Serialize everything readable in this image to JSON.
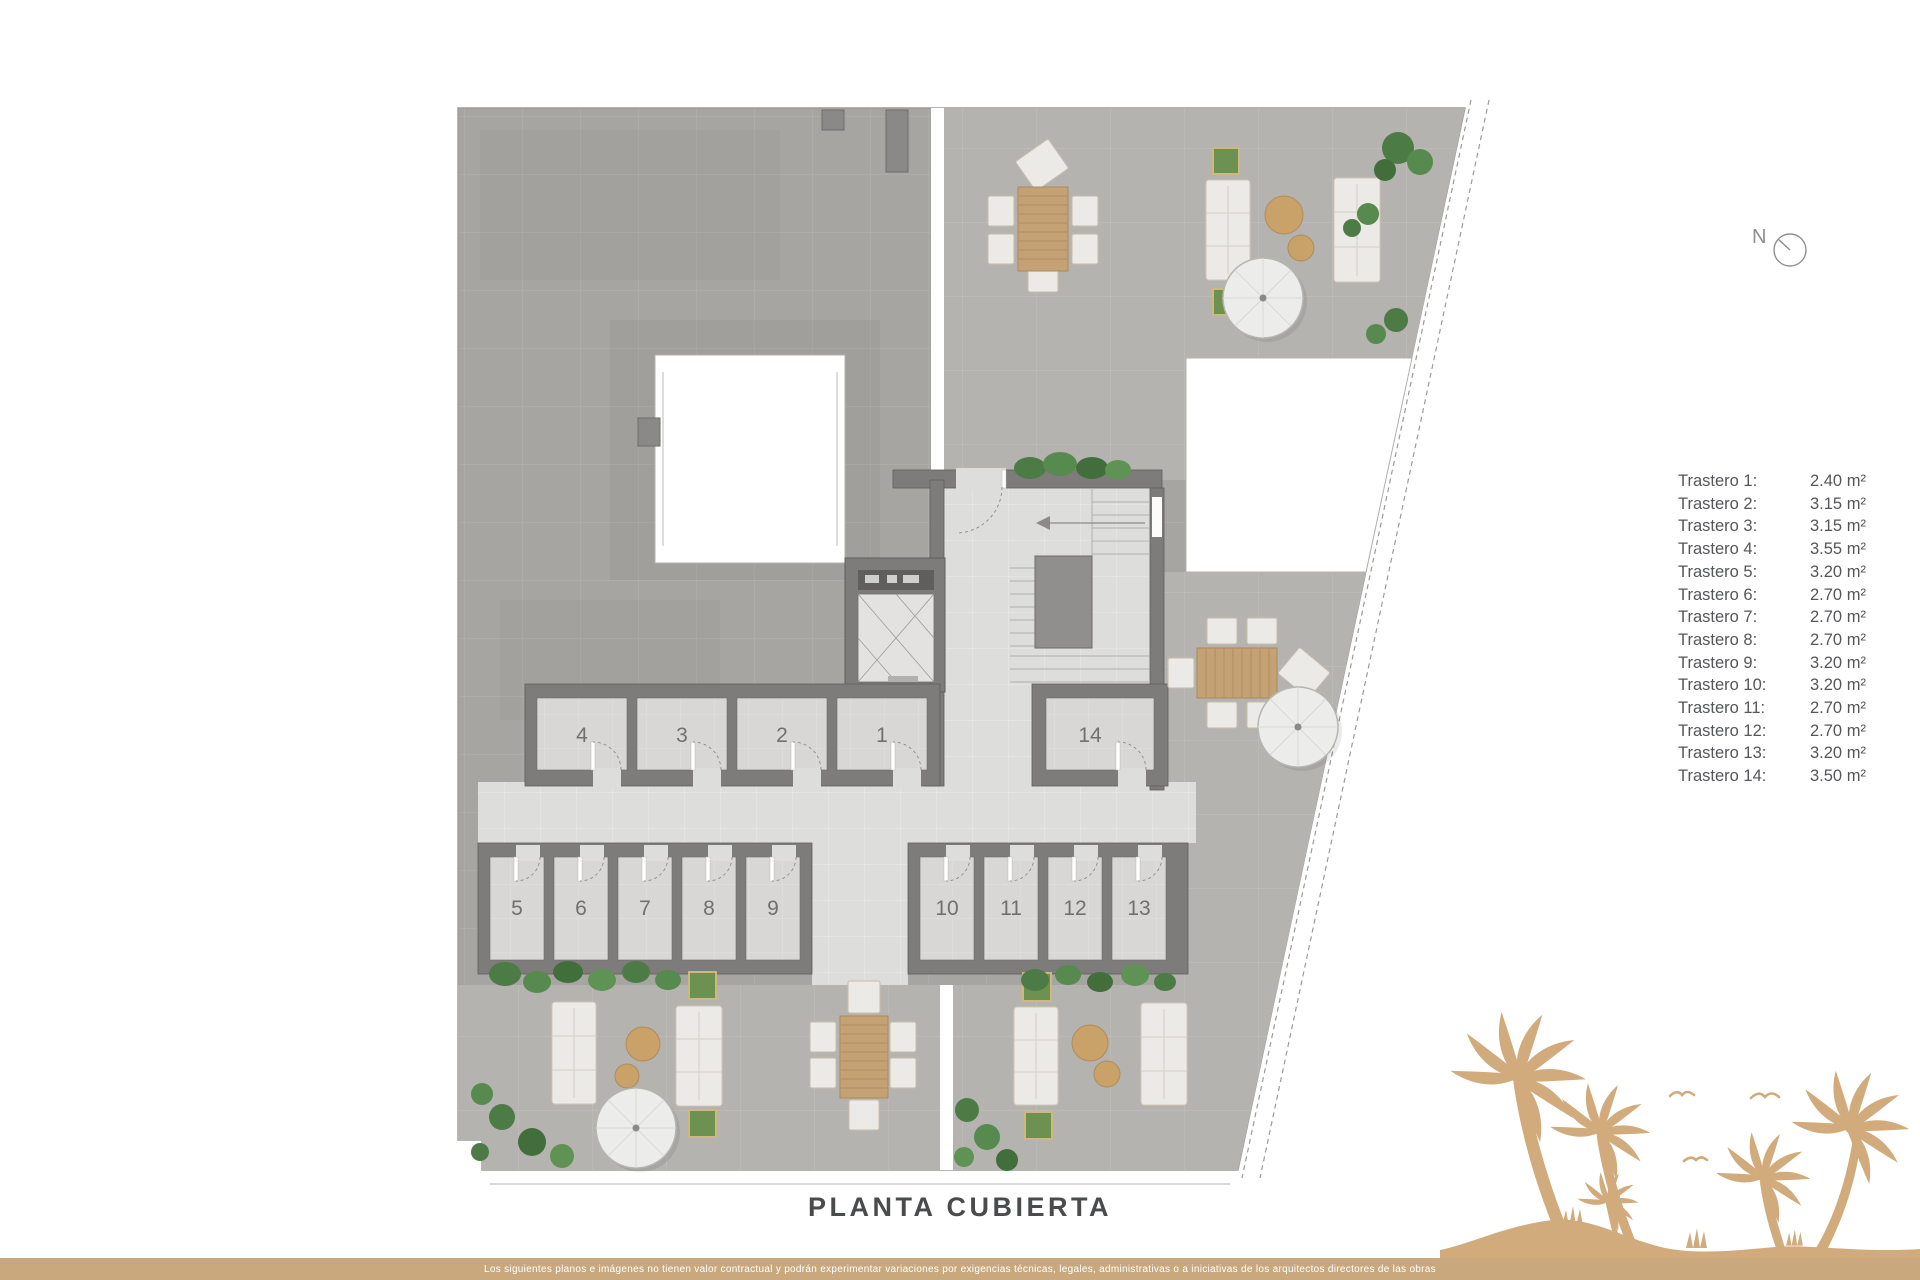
{
  "page": {
    "title": "PLANTA CUBIERTA"
  },
  "compass": {
    "label": "N"
  },
  "legend": {
    "items": [
      {
        "label": "Trastero 1:",
        "value": "2.40 m²"
      },
      {
        "label": "Trastero 2:",
        "value": "3.15 m²"
      },
      {
        "label": "Trastero 3:",
        "value": "3.15 m²"
      },
      {
        "label": "Trastero 4:",
        "value": "3.55 m²"
      },
      {
        "label": "Trastero 5:",
        "value": "3.20 m²"
      },
      {
        "label": "Trastero 6:",
        "value": "2.70 m²"
      },
      {
        "label": "Trastero 7:",
        "value": "2.70 m²"
      },
      {
        "label": "Trastero 8:",
        "value": "2.70 m²"
      },
      {
        "label": "Trastero 9:",
        "value": "3.20 m²"
      },
      {
        "label": "Trastero 10:",
        "value": "3.20 m²"
      },
      {
        "label": "Trastero 11:",
        "value": "2.70 m²"
      },
      {
        "label": "Trastero 12:",
        "value": "2.70 m²"
      },
      {
        "label": "Trastero 13:",
        "value": "3.20 m²"
      },
      {
        "label": "Trastero 14:",
        "value": "3.50 m²"
      }
    ]
  },
  "plan": {
    "rooms": [
      "4",
      "3",
      "2",
      "1",
      "14",
      "5",
      "6",
      "7",
      "8",
      "9",
      "10",
      "11",
      "12",
      "13"
    ]
  },
  "footer": {
    "disclaimer": "Los siguientes planos e imágenes no tienen valor contractual y podrán experimentar variaciones por exigencias técnicas, legales, administrativas o a iniciativas de los arquitectos directores de las obras"
  },
  "colors": {
    "accent_tan": "#c9a87e",
    "palm_tan": "#d2ab7c",
    "wall_gray": "#7d7c7a",
    "text_gray": "#55565a"
  }
}
